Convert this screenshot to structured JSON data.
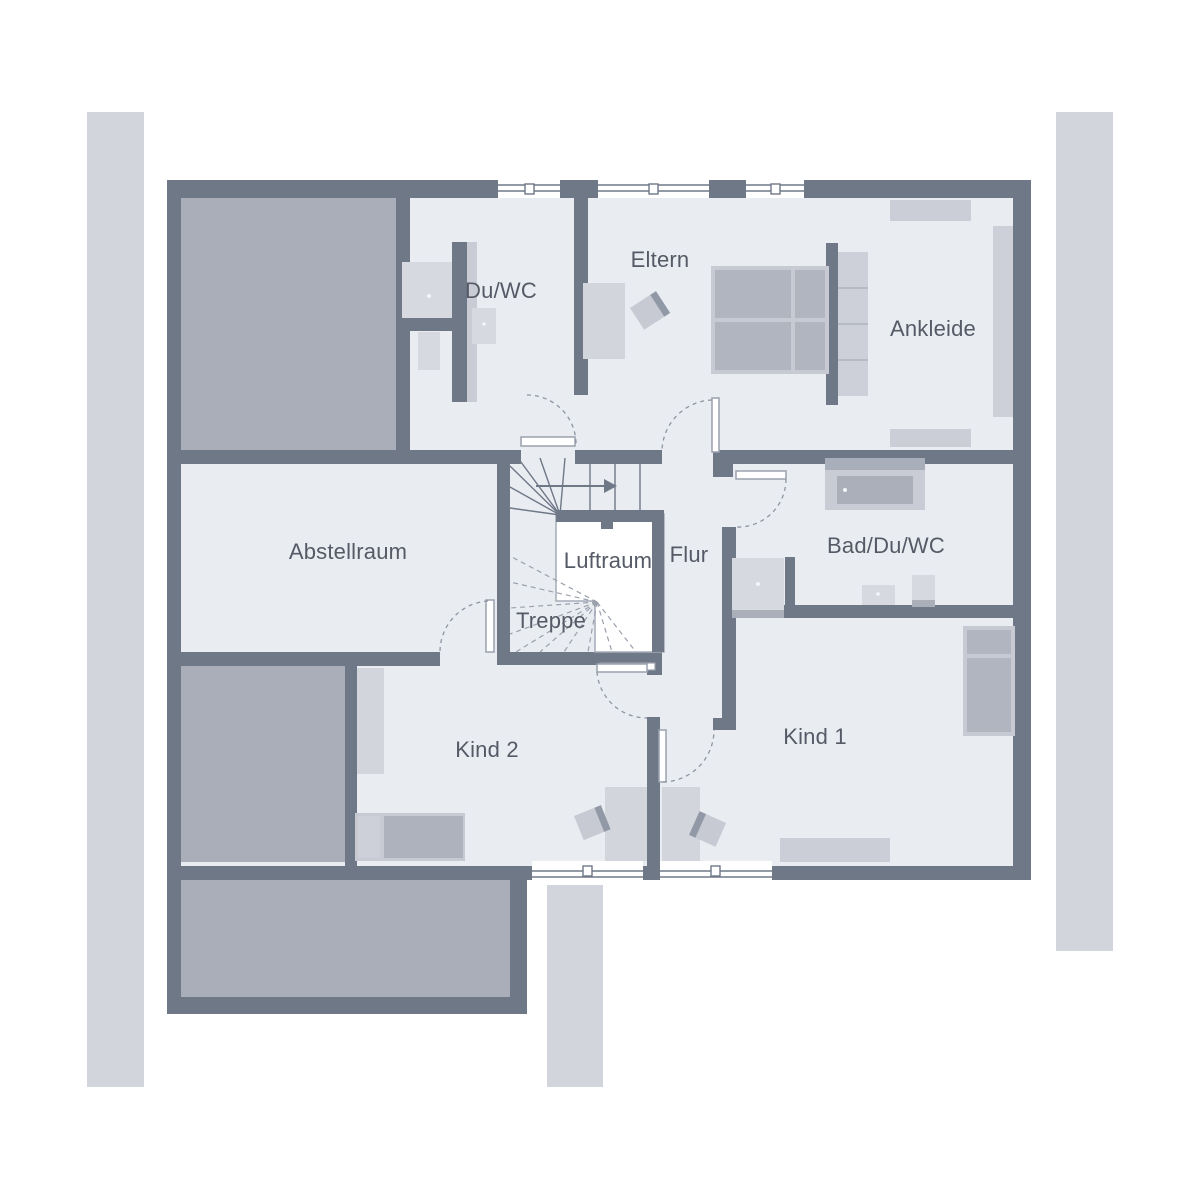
{
  "plan": {
    "title": "Obergeschoss Grundriss",
    "rooms": [
      {
        "id": "du-wc",
        "label": "Du/WC",
        "cx": 501,
        "cy": 291
      },
      {
        "id": "eltern",
        "label": "Eltern",
        "cx": 660,
        "cy": 260
      },
      {
        "id": "ankleide",
        "label": "Ankleide",
        "cx": 933,
        "cy": 329
      },
      {
        "id": "abstellraum",
        "label": "Abstellraum",
        "cx": 348,
        "cy": 552
      },
      {
        "id": "luftraum",
        "label": "Luftraum",
        "cx": 608,
        "cy": 561
      },
      {
        "id": "flur",
        "label": "Flur",
        "cx": 689,
        "cy": 555
      },
      {
        "id": "treppe",
        "label": "Treppe",
        "cx": 551,
        "cy": 621
      },
      {
        "id": "bad-du-wc",
        "label": "Bad/Du/WC",
        "cx": 886,
        "cy": 546
      },
      {
        "id": "kind-2",
        "label": "Kind 2",
        "cx": 487,
        "cy": 750
      },
      {
        "id": "kind-1",
        "label": "Kind 1",
        "cx": 815,
        "cy": 737
      }
    ],
    "palette": {
      "wall": "#6F7887",
      "wall_light": "#9BA1AD",
      "floor": "#E9ECF1",
      "roof_area": "#A9AEB9",
      "furniture_light": "#D7D9E1",
      "furniture_medium": "#B1B5C0",
      "furniture_frame": "#C7CAD3",
      "outside_strip": "#D3D5DC",
      "void_white": "#FFFFFF",
      "label_text": "#555A66",
      "door_arc": "#8E95A2"
    }
  }
}
